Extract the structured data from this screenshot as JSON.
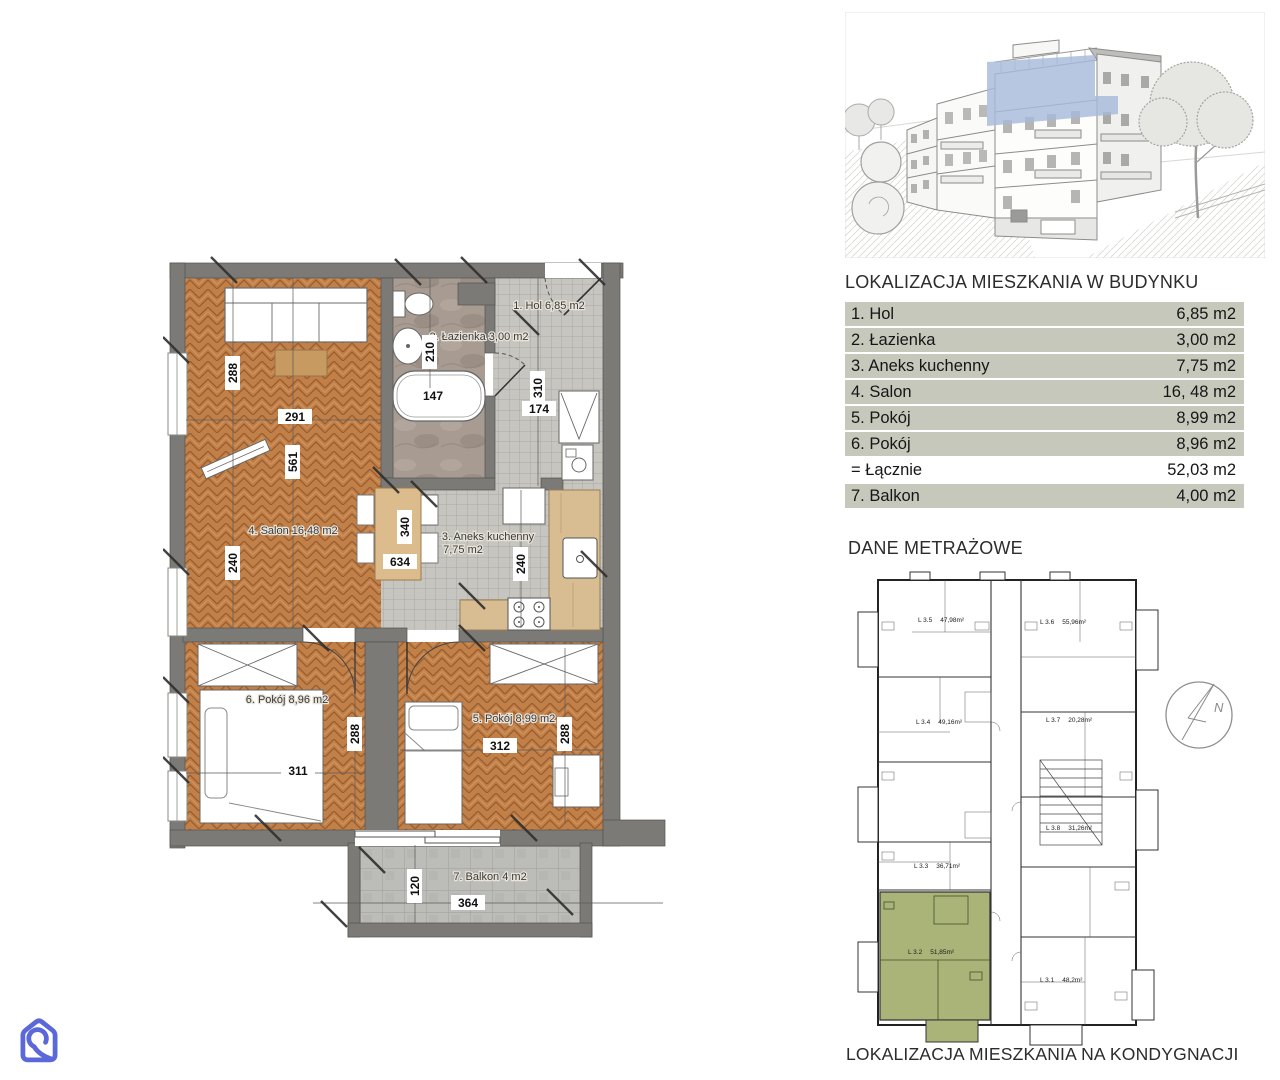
{
  "logo": {
    "name": "house-loop-logo",
    "color": "#5b68d9"
  },
  "building_view": {
    "highlight_color": "#a7badb"
  },
  "location_table": {
    "title": "LOKALIZACJA MIESZKANIA W BUDYNKU",
    "rows": [
      {
        "label": "1. Hol",
        "value": "6,85 m2"
      },
      {
        "label": "2. Łazienka",
        "value": "3,00 m2"
      },
      {
        "label": "3. Aneks kuchenny",
        "value": "7,75 m2"
      },
      {
        "label": "4. Salon",
        "value": "16, 48 m2"
      },
      {
        "label": "5. Pokój",
        "value": "8,99 m2"
      },
      {
        "label": "6. Pokój",
        "value": "8,96 m2"
      },
      {
        "label": "= Łącznie",
        "value": "52,03 m2"
      },
      {
        "label": "7. Balkon",
        "value": "4,00 m2"
      }
    ]
  },
  "sections": {
    "dane_metrazowe": "DANE METRAŻOWE",
    "kondygnacja": "LOKALIZACJA MIESZKANIA NA KONDYGNACJI"
  },
  "apartment_plan": {
    "labels": {
      "hol": "1. Hol 6,85 m2",
      "lazienka": "2. Łazienka 3,00 m2",
      "aneks1": "3. Aneks kuchenny",
      "aneks2": "7,75 m2",
      "salon": "4. Salon 16,48 m2",
      "pokoj6": "6. Pokój 8,96 m2",
      "pokoj5": "5. Pokój 8,99 m2",
      "balkon": "7. Balkon 4 m2"
    },
    "dims": {
      "d288a": "288",
      "d291": "291",
      "d561": "561",
      "d240a": "240",
      "d210": "210",
      "d147": "147",
      "d310": "310",
      "d174": "174",
      "d340": "340",
      "d634": "634",
      "d240b": "240",
      "d311": "311",
      "d288b": "288",
      "d312": "312",
      "d288c": "288",
      "d120": "120",
      "d364": "364"
    }
  },
  "storey_plan": {
    "units": [
      {
        "label": "L 3.5",
        "area": "47,98m²"
      },
      {
        "label": "L 3.6",
        "area": "55,96m²"
      },
      {
        "label": "L 3.4",
        "area": "49,16m²"
      },
      {
        "label": "L 3.7",
        "area": "20,28m²"
      },
      {
        "label": "L 3.8",
        "area": "31,26m²"
      },
      {
        "label": "L 3.3",
        "area": "36,71m²"
      },
      {
        "label": "L 3.2",
        "area": "51,85m²"
      },
      {
        "label": "L 3.1",
        "area": "48,2m²"
      }
    ],
    "highlight_color": "#aab478",
    "compass": "N"
  }
}
